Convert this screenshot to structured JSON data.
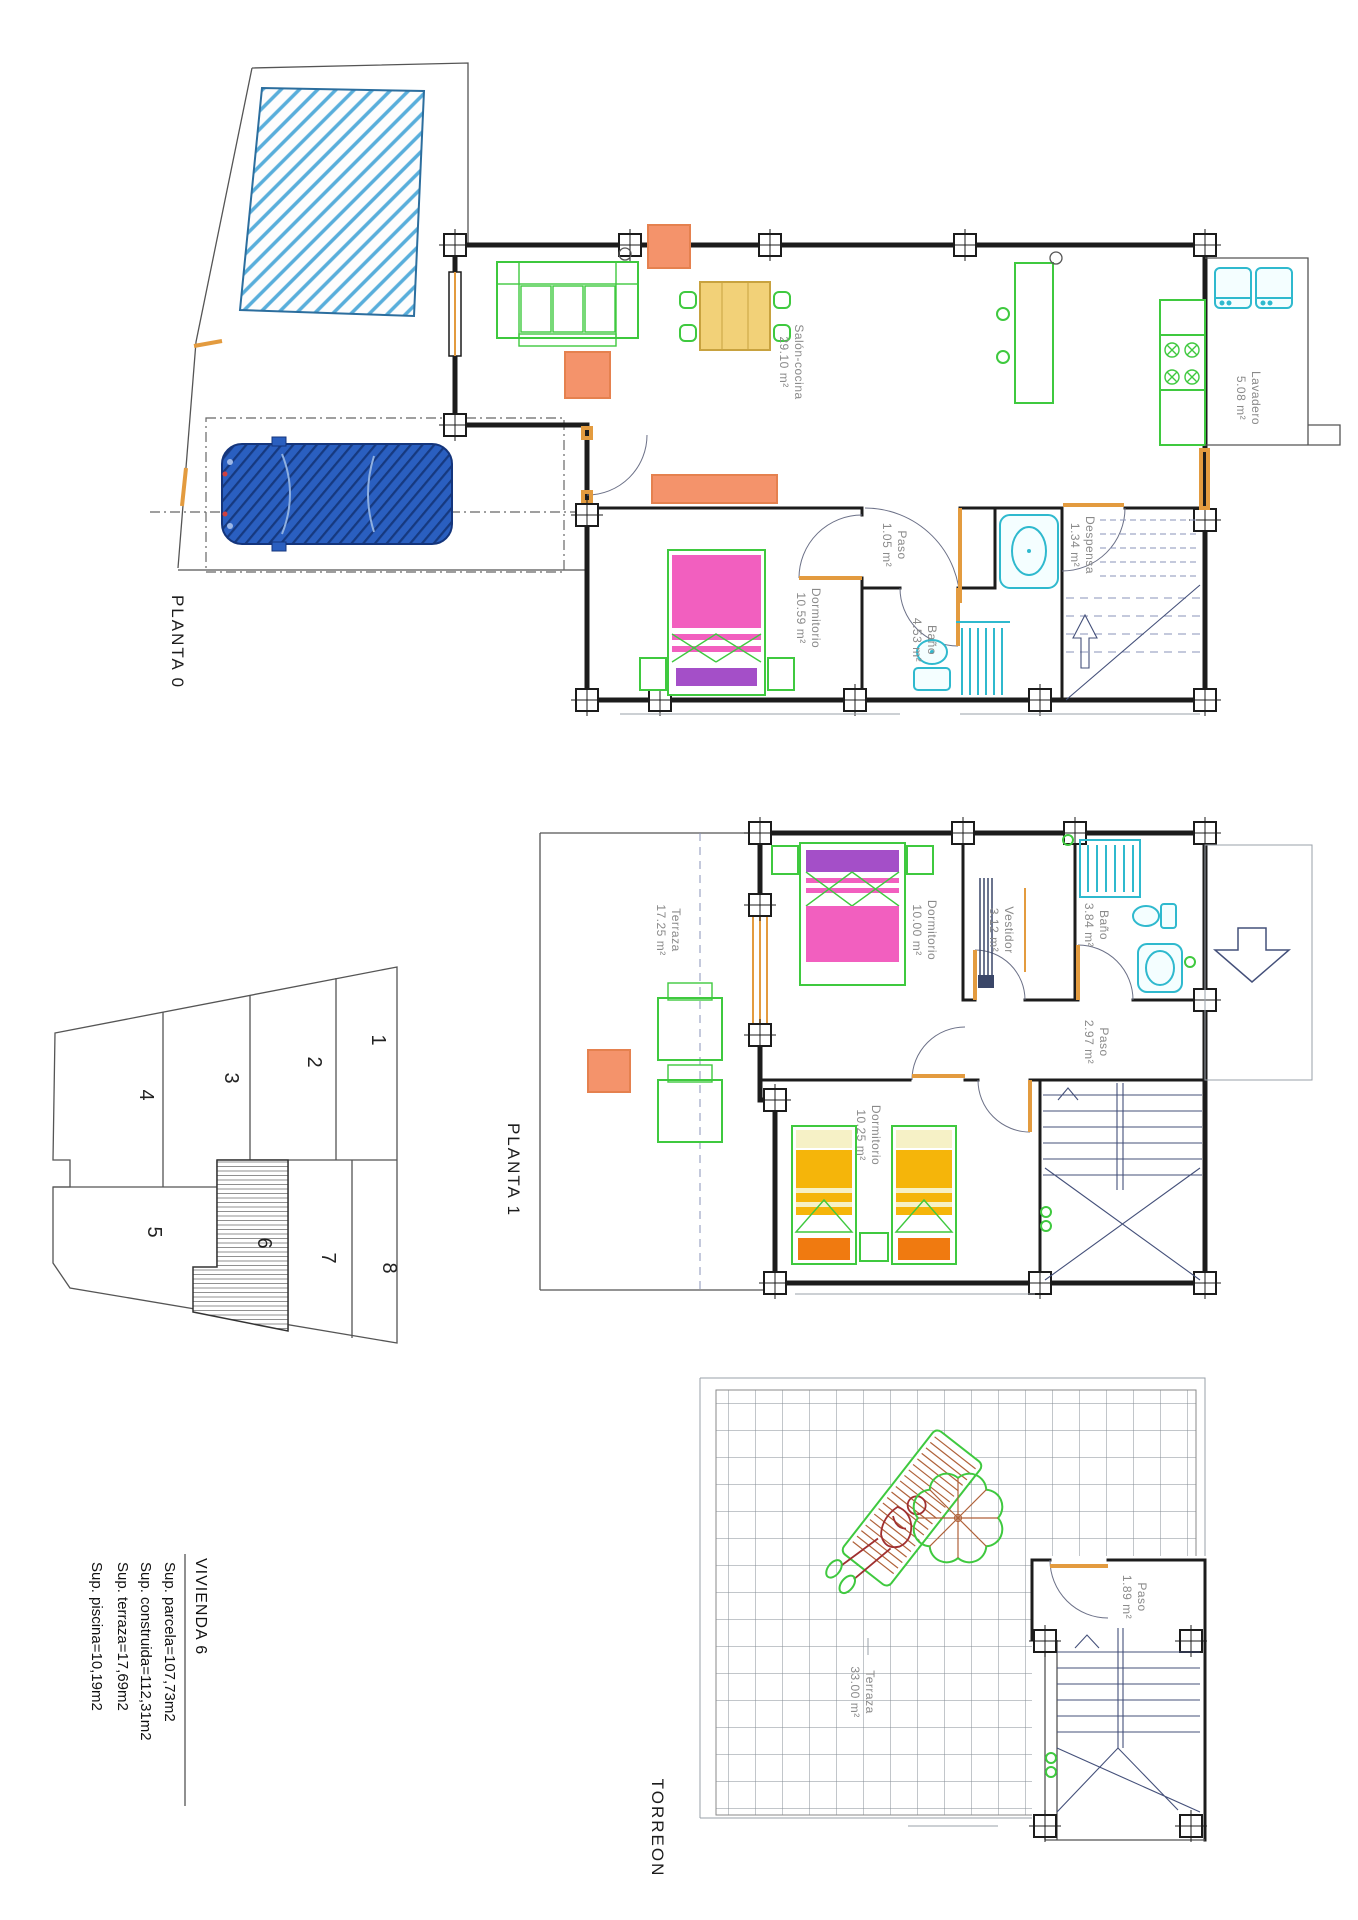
{
  "sheet": {
    "background": "#ffffff"
  },
  "plans": {
    "planta0": {
      "title": "PLANTA 0",
      "rooms": [
        {
          "name": "Salón-cocina",
          "area": "29.10 m²"
        },
        {
          "name": "Paso",
          "area": "1.05 m²"
        },
        {
          "name": "Dormitorio",
          "area": "10.59 m²"
        },
        {
          "name": "Baño",
          "area": "4.53 m²"
        },
        {
          "name": "Despensa",
          "area": "1.34 m²"
        },
        {
          "name": "Lavadero",
          "area": "5.08 m²"
        }
      ]
    },
    "planta1": {
      "title": "PLANTA 1",
      "rooms": [
        {
          "name": "Terraza",
          "area": "17.25 m²"
        },
        {
          "name": "Dormitorio",
          "area": "10.00 m²"
        },
        {
          "name": "Vestidor",
          "area": "3.12 m²"
        },
        {
          "name": "Baño",
          "area": "3.84 m²"
        },
        {
          "name": "Paso",
          "area": "2.97 m²"
        },
        {
          "name": "Dormitorio",
          "area": "10.25 m²"
        }
      ]
    },
    "torreon": {
      "title": "TORREON",
      "rooms": [
        {
          "name": "Terraza",
          "area": "33.00 m²"
        },
        {
          "name": "Paso",
          "area": "1.89 m²"
        }
      ]
    }
  },
  "site_plan": {
    "plots": [
      "1",
      "2",
      "3",
      "4",
      "5",
      "6",
      "7",
      "8"
    ],
    "highlighted_plot": "6"
  },
  "info_block": {
    "title": "VIVIENDA 6",
    "lines": [
      "Sup. parcela=107,73m2",
      "Sup. construida=112,31m2",
      "Sup. terraza=17,69m2",
      "Sup. piscina=10,19m2"
    ]
  },
  "colors": {
    "walls": "#1c1c1c",
    "furniture_green": "#3fc93f",
    "sanitary_cyan": "#2fb9ce",
    "door_orange": "#e39b3f",
    "bed_pink": "#f25fbf",
    "headboard_purple": "#a44fc8",
    "bed_yellow": "#f5b50a",
    "bed_orange_accent": "#f07a10",
    "table_orange": "#f4936b",
    "pool_blue": "#58aedb",
    "car_blue": "#2a5fc0",
    "label_gray": "#8a8a8a"
  }
}
